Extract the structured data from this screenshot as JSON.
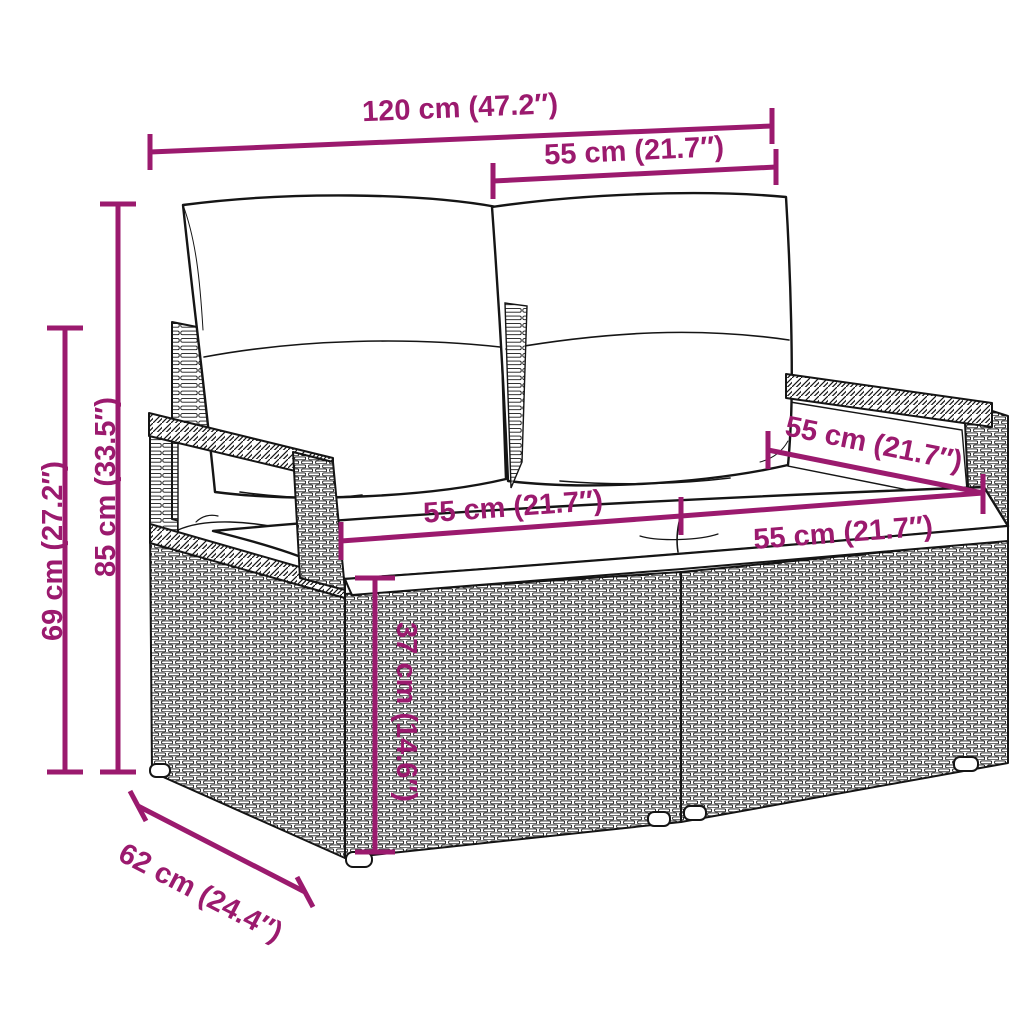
{
  "page": {
    "background": "#ffffff",
    "accent_color": "#9b1a6e",
    "outline_color": "#151515",
    "subject": "poly-rattan two-seater garden sofa with cushions, dimension drawing"
  },
  "diagram": {
    "dimensions": {
      "overall_width": {
        "cm": 120,
        "inches": 47.2,
        "label": "120 cm (47.2″)"
      },
      "backrest_width": {
        "cm": 55,
        "inches": 21.7,
        "label": "55 cm (21.7″)"
      },
      "total_height": {
        "cm": 85,
        "inches": 33.5,
        "label": "85 cm (33.5″)"
      },
      "armrest_height": {
        "cm": 69,
        "inches": 27.2,
        "label": "69 cm (27.2″)"
      },
      "depth": {
        "cm": 62,
        "inches": 24.4,
        "label": "62 cm (24.4″)"
      },
      "seat_height": {
        "cm": 37,
        "inches": 14.6,
        "label": "37 cm (14.6″)"
      },
      "seat_width_left": {
        "cm": 55,
        "inches": 21.7,
        "label": "55 cm (21.7″)"
      },
      "seat_width_right": {
        "cm": 55,
        "inches": 21.7,
        "label": "55 cm (21.7″)"
      },
      "armrest_depth": {
        "cm": 55,
        "inches": 21.7,
        "label": "55 cm (21.7″)"
      }
    }
  }
}
